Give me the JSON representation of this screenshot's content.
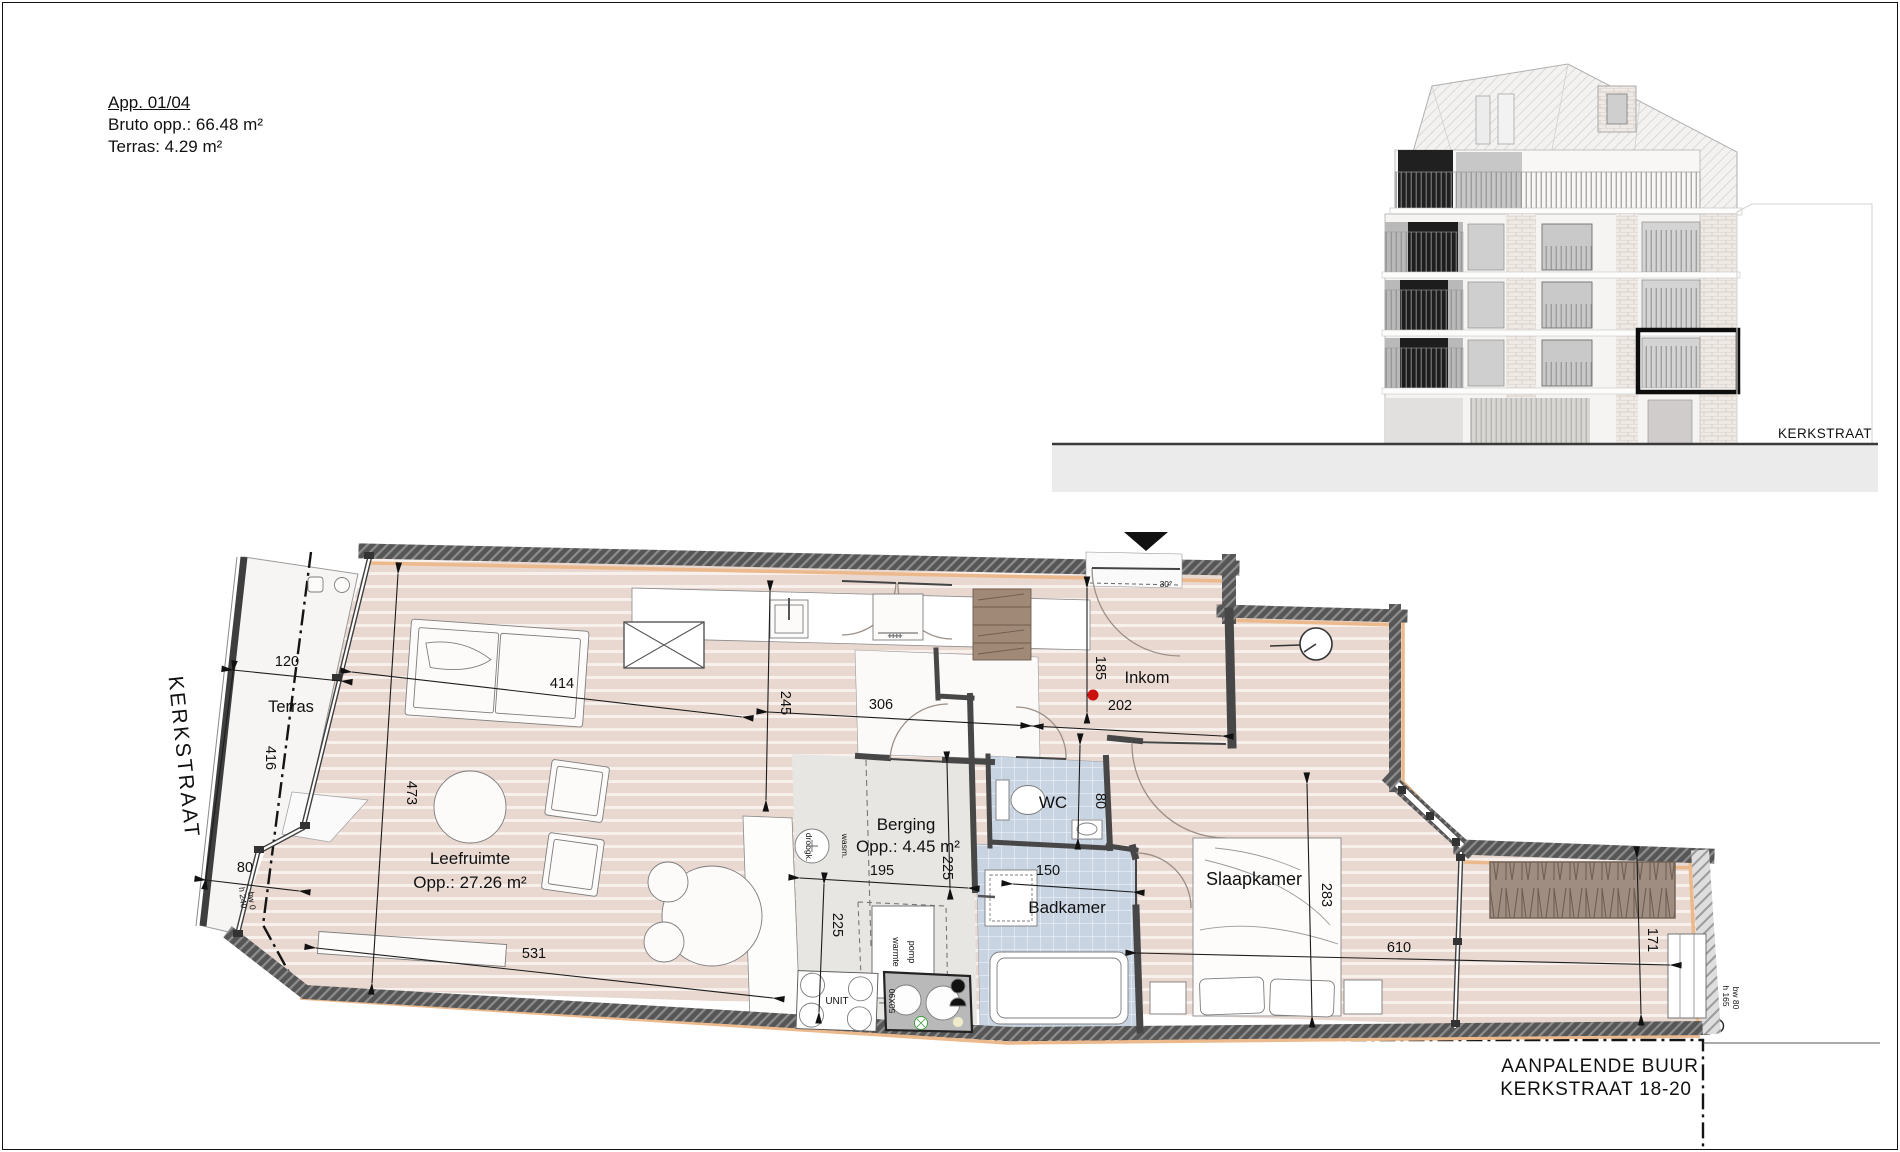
{
  "header": {
    "title": "App. 01/04",
    "bruto": "Bruto opp.: 66.48 m²",
    "terras": "Terras: 4.29 m²"
  },
  "street_left": "KERKSTRAAT",
  "elevation": {
    "street_label": "KERKSTRAAT"
  },
  "rooms": {
    "terras": "Terras",
    "leefruimte": "Leefruimte",
    "leefruimte_opp": "Opp.: 27.26 m²",
    "berging": "Berging",
    "berging_opp": "Opp.: 4.45 m²",
    "wc": "WC",
    "badkamer": "Badkamer",
    "inkom": "Inkom",
    "slaapkamer": "Slaapkamer"
  },
  "dims": {
    "terras_width": "120",
    "terras_length": "416",
    "terras_bottom": "80",
    "living_width": "414",
    "living_depth": "473",
    "living_bottom": "531",
    "kitchen_depth": "245",
    "hall_a": "306",
    "hall_b": "202",
    "entry_depth": "185",
    "wc_depth": "80",
    "berging_width": "195",
    "berging_depth": "225",
    "kitchen_strip": "225",
    "badkamer_width": "150",
    "bedroom_depth": "283",
    "bedroom_width": "610",
    "terrace_depth": "171"
  },
  "annotations": {
    "door_angle": "30°",
    "terras_sill": [
      "h 240",
      "bw 0"
    ],
    "window_sill": [
      "h 165",
      "bw 80"
    ],
    "sink_size": "50X90",
    "unit": "UNIT",
    "washer": "wasm.",
    "dryer": "droogk.",
    "heatpump": [
      "warmte",
      "pomp"
    ]
  },
  "neighbor": {
    "line1": "AANPALENDE BUUR",
    "line2": "KERKSTRAAT 18-20"
  },
  "colors": {
    "floor_pink": "#e9d8d0",
    "tile_blue": "#c9d4e3",
    "wall_dark": "#565656",
    "insulation_orange": "#ecb98c",
    "service_gray": "#e7e6e3",
    "planter_brown": "#9e8d80",
    "highlight_red": "#cc1111"
  }
}
